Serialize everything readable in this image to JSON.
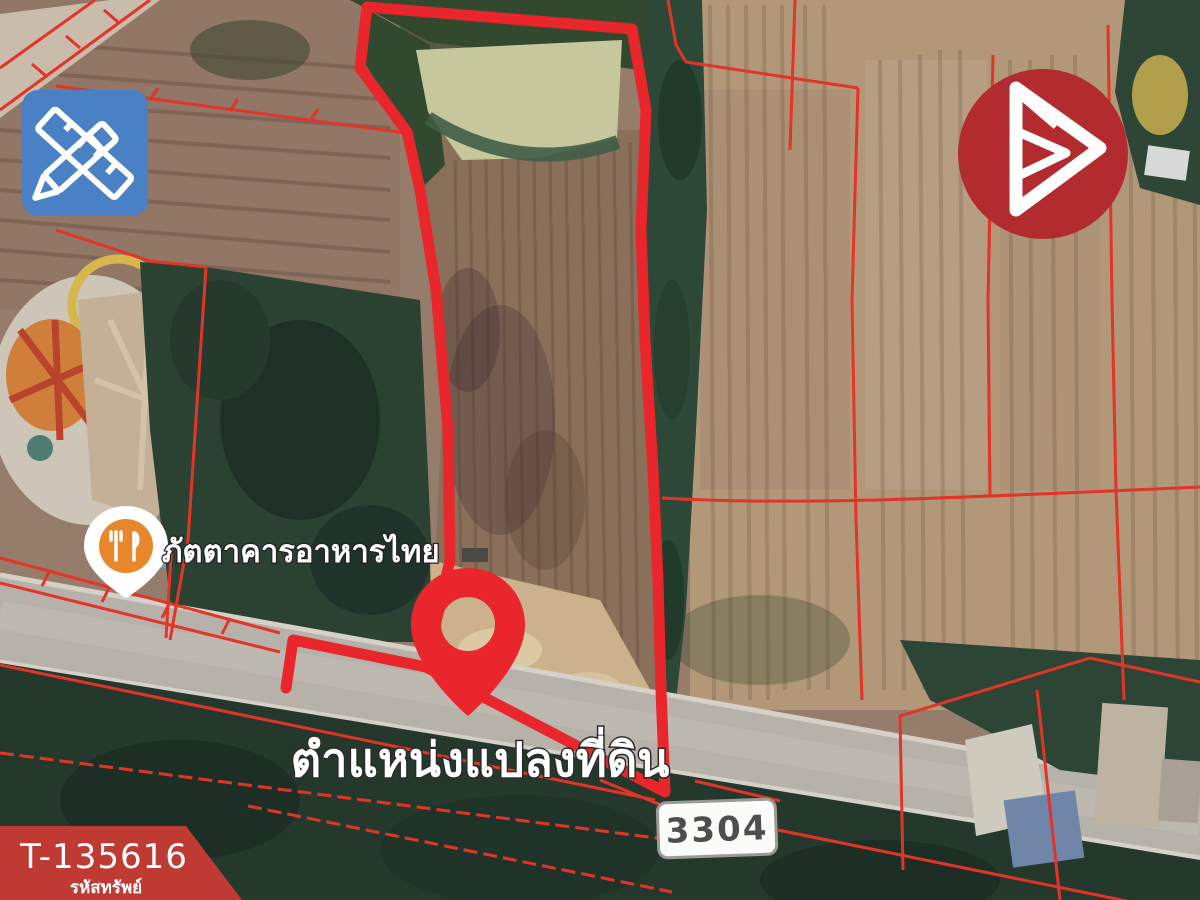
{
  "overlay": {
    "land_position_label": "ตำแหน่งแปลงที่ดิน",
    "route_badge": "3304",
    "restaurant_label": "ภัตตาคารอาหารไทย"
  },
  "property_tag": {
    "code": "T-135616",
    "code_label": "รหัสทรัพย์"
  },
  "icons": {
    "tool_icon": "ruler-and-pencil",
    "brand_logo": "triangle-b-monogram",
    "restaurant_icon": "fork-and-knife",
    "pin_icon": "map-pin"
  },
  "colors": {
    "boundary_red": "#e8262b",
    "parcel_red": "#e23428",
    "pin_red": "#e8262b",
    "marker_orange": "#e8872c",
    "tool_blue": "#4a80c4",
    "logo_red": "#b12b2f",
    "banner_red": "#bf3a33",
    "road_gray": "#b7b2a9",
    "pond_green": "#c6c79c"
  }
}
